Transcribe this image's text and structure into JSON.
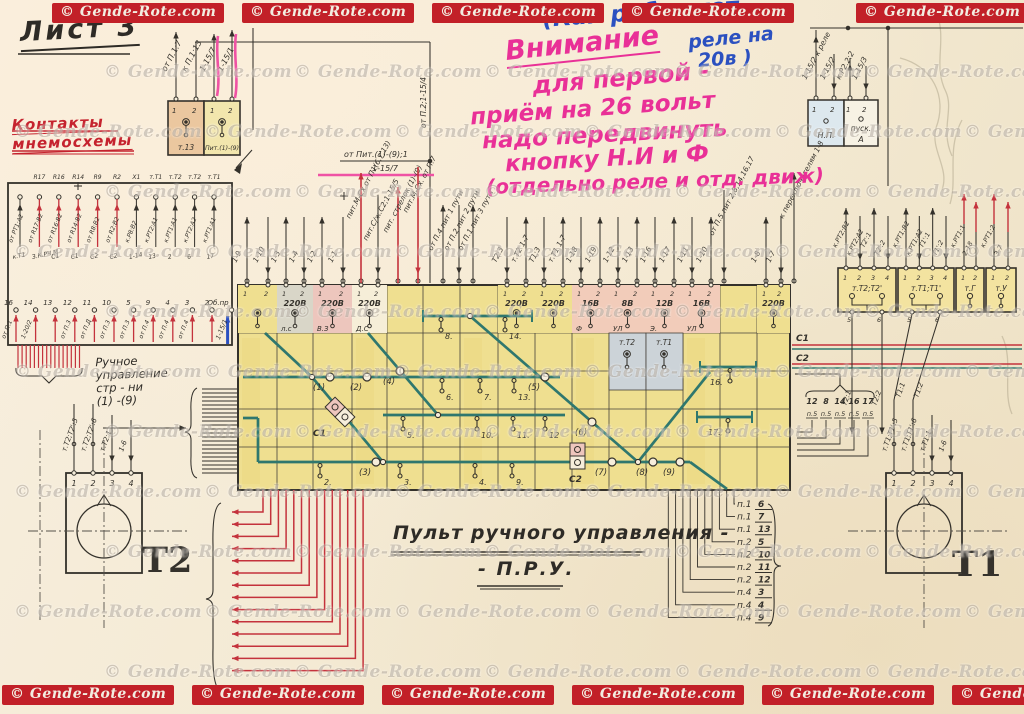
{
  "watermark": {
    "text": "© Gende-Rote.com"
  },
  "titles": {
    "sheet": "Лист 3",
    "contacts1": "Контакты",
    "contacts2": "мнемосхемы",
    "main1": "Пульт ручного управления -",
    "main2": "- П.Р.У.",
    "t2": "Т2",
    "t1": "Т1"
  },
  "handwriting": {
    "blue1": "(Как работают",
    "blue2": "реле на",
    "blue3": "20в )",
    "pink1": "Внимание",
    "pink2": "для первой -",
    "pink3": "приём на 26 вольт",
    "pink4": "надо передвинуть",
    "pink5": "кнопку Н.И и Ф",
    "pink6": "(отдельно реле и отд. движ)"
  },
  "annotations": {
    "feed1": "от Пит.(1)-(9);1",
    "feed2": "1-15/7",
    "vert_bus": "от П.2;1-15/4",
    "manual": [
      "Ручное",
      "управление",
      "стр - ни",
      "(1) -(9)"
    ]
  },
  "top_left_block": {
    "cells": [
      "т.13",
      "Пит.(1)-(9)"
    ],
    "terminals": [
      "1",
      "2",
      "1",
      "2"
    ],
    "wires": [
      "от П.1:7",
      "к П.1:13",
      "1-15/7",
      "1-15/1"
    ]
  },
  "np_block": {
    "cells": [
      "Н.П.",
      "пуск.",
      "А"
    ],
    "terminals": [
      "1",
      "2",
      "1",
      "2"
    ],
    "wires": [
      "1-15/2 к реле",
      "1-15/2",
      "к.Р2.2:2",
      "1-15/3"
    ]
  },
  "left_block": {
    "headers": [
      "R17",
      "R16",
      "R14",
      "R9",
      "R2",
      "X1",
      "т.Т1",
      "т.Т2",
      "т.Т2",
      "т.Т1"
    ],
    "top_wires": [
      "от РТ1:А2",
      "от R17:В2",
      "от R16:В2",
      "от R14:В2",
      "от R8:В2",
      "от R2:В2",
      "к.Р8:В2",
      "к.РТ2:А1",
      "к.РТ1:А1",
      "к.РТ2:А2",
      "к.РТ1:А1"
    ],
    "mid_labels": [
      "к.Т1",
      "З.К.РЧ.М",
      "С1",
      "С1",
      "С2",
      "С2",
      "1-14",
      "13",
      "2",
      "6",
      "17"
    ],
    "bottom_nums": [
      "16",
      "14",
      "13",
      "12",
      "11",
      "10",
      "5",
      "9",
      "4",
      "3",
      "2",
      "Об.пр"
    ],
    "bottom_wires": [
      "от П.1",
      "1-20/2",
      "",
      "от П.3",
      "от П.Д",
      "от П.3",
      "от П.3",
      "от П.4",
      "от П.4",
      "от П.4",
      "",
      ""
    ],
    "blue_label": "1-15/1"
  },
  "relay_strip": {
    "blocks": [
      {
        "w": 58,
        "label": "т.Т2;Т2'",
        "terms": [
          "1",
          "2",
          "3",
          "4"
        ],
        "wires": [
          "к.РТ2:В2",
          "к.РТ2:А2",
          "Т2':1",
          "Т2':2"
        ],
        "bottom": [
          "5",
          "6"
        ]
      },
      {
        "w": 56,
        "label": "т.Т1;Т1'",
        "terms": [
          "1",
          "2",
          "3",
          "4"
        ],
        "wires": [
          "к.РТ1:В2",
          "к.РТ1:А2",
          "Т1':1",
          "Т1':2"
        ],
        "bottom": [
          "5",
          "6"
        ]
      },
      {
        "w": 28,
        "label": "т.Г",
        "terms": [
          "1",
          "2"
        ],
        "wires": [
          "к.РТ1:1",
          "2-18"
        ],
        "red": true
      },
      {
        "w": 30,
        "label": "т.У",
        "terms": [
          "1",
          "2"
        ],
        "wires": [
          "к.РТ1:2",
          "3-7"
        ],
        "red": true
      }
    ]
  },
  "c1c2": {
    "labels": [
      "С1",
      "С2"
    ],
    "wires": [
      "Т2:1",
      "Т2:2",
      "Т1:1",
      "Т1:2"
    ]
  },
  "p5": {
    "nums": [
      "12",
      "8",
      "14",
      "16",
      "17"
    ],
    "sub": "п.5"
  },
  "panel": {
    "wires": [
      {
        "x": 247,
        "l": "1-9"
      },
      {
        "x": 268,
        "l": "1-10"
      },
      {
        "x": 286,
        "l": "1-3"
      },
      {
        "x": 304,
        "l": "1-4"
      },
      {
        "x": 322,
        "l": "1-2"
      },
      {
        "x": 343,
        "l": "1-1"
      },
      {
        "x": 361,
        "l": "пит.М-Сх от П1(6,7,13)",
        "red": true,
        "h": 112
      },
      {
        "x": 378,
        "l": "пит.С/ж.С2;1-15/5",
        "h": 90
      },
      {
        "x": 398,
        "l": "пит. стрелок (1)-(9)",
        "red": true,
        "h": 98
      },
      {
        "x": 418,
        "l": "пит.М-Сх. от П.7",
        "red": true,
        "h": 118
      },
      {
        "x": 443,
        "l": "от П.4 пит 1 пути",
        "h": 80
      },
      {
        "x": 459,
        "l": "от П.2 пит 2 пути",
        "h": 80
      },
      {
        "x": 473,
        "l": "от П.1 пит 3 пути",
        "h": 80
      },
      {
        "x": 507,
        "l": "Т2:3"
      },
      {
        "x": 526,
        "l": "т.Т2 1-7"
      },
      {
        "x": 544,
        "l": "Т1:3"
      },
      {
        "x": 563,
        "l": "т.Т1 1-7"
      },
      {
        "x": 581,
        "l": "1-18"
      },
      {
        "x": 600,
        "l": "1-19"
      },
      {
        "x": 618,
        "l": "1-12"
      },
      {
        "x": 637,
        "l": "1-13"
      },
      {
        "x": 655,
        "l": "1-16"
      },
      {
        "x": 674,
        "l": "1-17"
      },
      {
        "x": 692,
        "l": "1-11"
      },
      {
        "x": 711,
        "l": "1-10"
      },
      {
        "x": 724,
        "l": "от П.5 пит 2,8,14,16,17",
        "h": 95
      },
      {
        "x": 766,
        "l": "1-8"
      },
      {
        "x": 781,
        "l": "1-7"
      },
      {
        "x": 794,
        "l": "к переключателям 1-8",
        "h": 112
      }
    ],
    "cells": [
      {
        "i": 0,
        "fill": "#efdf90",
        "volt": "",
        "label": ""
      },
      {
        "i": 1,
        "fill": "#d9d6c8",
        "volt": "220В",
        "label": "л.с"
      },
      {
        "i": 2,
        "fill": "#edc6bd",
        "volt": "220В",
        "label": "В.З"
      },
      {
        "i": 3,
        "fill": "#f6eed8",
        "volt": "220В",
        "label": "Д.С"
      },
      {
        "i": 7,
        "fill": "#efdf90",
        "volt": "220В",
        "label": ""
      },
      {
        "i": 8,
        "fill": "#efdf90",
        "volt": "220В",
        "label": ""
      },
      {
        "i": 9,
        "fill": "#f2ccba",
        "volt": "16В",
        "label": "Ф"
      },
      {
        "i": 10,
        "fill": "#f2ccba",
        "volt": "8В",
        "label": "УЛ"
      },
      {
        "i": 11,
        "fill": "#f2ccba",
        "volt": "12В",
        "label": "Э."
      },
      {
        "i": 12,
        "fill": "#f2ccba",
        "volt": "16В",
        "label": "УЛ"
      },
      {
        "i": 14,
        "fill": "#efdf90",
        "volt": "220В",
        "label": ""
      }
    ],
    "gray_cells": [
      "т.Т2",
      "т.Т1"
    ],
    "switches": [
      {
        "x": 330,
        "y": 377,
        "l": "(1)"
      },
      {
        "x": 367,
        "y": 377,
        "l": "(2)"
      },
      {
        "x": 376,
        "y": 462,
        "l": "(3)"
      },
      {
        "x": 400,
        "y": 371,
        "l": "(4)"
      },
      {
        "x": 545,
        "y": 377,
        "l": "(5)"
      },
      {
        "x": 592,
        "y": 422,
        "l": "(6)"
      },
      {
        "x": 612,
        "y": 462,
        "l": "(7)"
      },
      {
        "x": 653,
        "y": 462,
        "l": "(8)"
      },
      {
        "x": 680,
        "y": 462,
        "l": "(9)"
      }
    ],
    "lamps": [
      {
        "x": 441,
        "y": 316,
        "l": "8."
      },
      {
        "x": 505,
        "y": 316,
        "l": "14."
      },
      {
        "x": 442,
        "y": 377,
        "l": "6."
      },
      {
        "x": 480,
        "y": 377,
        "l": "7."
      },
      {
        "x": 514,
        "y": 377,
        "l": "13."
      },
      {
        "x": 403,
        "y": 415,
        "l": "5."
      },
      {
        "x": 477,
        "y": 415,
        "l": "10."
      },
      {
        "x": 513,
        "y": 415,
        "l": "11."
      },
      {
        "x": 545,
        "y": 415,
        "l": "12"
      },
      {
        "x": 320,
        "y": 462,
        "l": "2."
      },
      {
        "x": 400,
        "y": 462,
        "l": "3."
      },
      {
        "x": 475,
        "y": 462,
        "l": "4."
      },
      {
        "x": 512,
        "y": 462,
        "l": "9."
      },
      {
        "x": 730,
        "y": 367,
        "l": "16.",
        "side": "left"
      },
      {
        "x": 728,
        "y": 417,
        "l": "17.",
        "side": "left"
      }
    ],
    "signals": [
      "С1",
      "С2"
    ]
  },
  "t_units": [
    {
      "label": "Т2",
      "wires": [
        "т.Т2;Т2':5",
        "т.Т2;Т2':6",
        "т.Т2:1",
        "1-6"
      ],
      "terms": [
        "1",
        "2",
        "3",
        "4"
      ]
    },
    {
      "label": "Т1",
      "wires": [
        "т.Т1;Т1':5",
        "т.Т1;Т1':6",
        "т.Т1:1",
        "1-6"
      ],
      "terms": [
        "1",
        "2",
        "3",
        "4"
      ]
    }
  ],
  "list_right": {
    "rows": [
      [
        "п.1",
        "6"
      ],
      [
        "п.1",
        "7"
      ],
      [
        "п.1",
        "13"
      ],
      [
        "п.2",
        "5"
      ],
      [
        "п.2",
        "10"
      ],
      [
        "п.2",
        "11"
      ],
      [
        "п.2",
        "12"
      ],
      [
        "п.4",
        "3"
      ],
      [
        "п.4",
        "4"
      ],
      [
        "п.4",
        "9"
      ]
    ]
  }
}
